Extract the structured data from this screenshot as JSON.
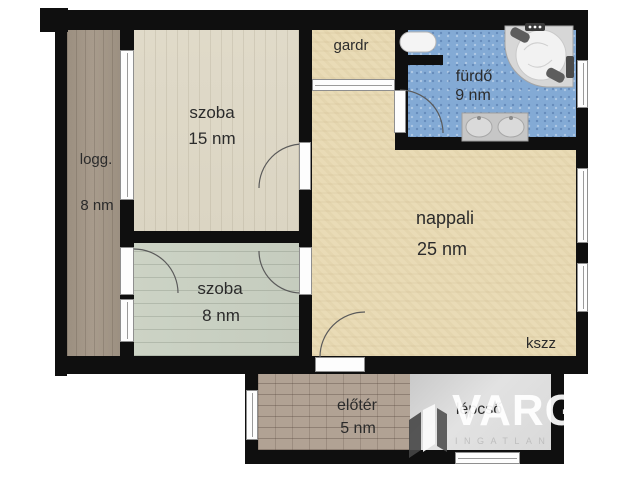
{
  "rooms": {
    "loggia": {
      "label": "logg.",
      "area": "8 nm"
    },
    "bedroom_large": {
      "label": "szoba",
      "area": "15 nm"
    },
    "bedroom_small": {
      "label": "szoba",
      "area": "8 nm"
    },
    "wardrobe": {
      "label": "gardr"
    },
    "bathroom": {
      "label": "fürdő",
      "area": "9 nm"
    },
    "living_room": {
      "label": "nappali",
      "area": "25 nm"
    },
    "storage": {
      "label": "kszz"
    },
    "hallway": {
      "label": "előtér",
      "area": "5 nm"
    },
    "stairs": {
      "label": "lépcső"
    }
  },
  "watermark": {
    "text": "VARG",
    "subtext": "INGATLAN"
  },
  "colors": {
    "wall": "#0f0f0f",
    "label_text": "#2b2b2b",
    "floor_loggia": "#a29585",
    "floor_bedroom_large": "#ded8c7",
    "floor_bedroom_small": "#c9d0c2",
    "floor_living": "#e9dbb6",
    "floor_bathroom": "#83aad5",
    "floor_hallway": "#b1a294",
    "floor_stairs": "#dcdcdc"
  }
}
